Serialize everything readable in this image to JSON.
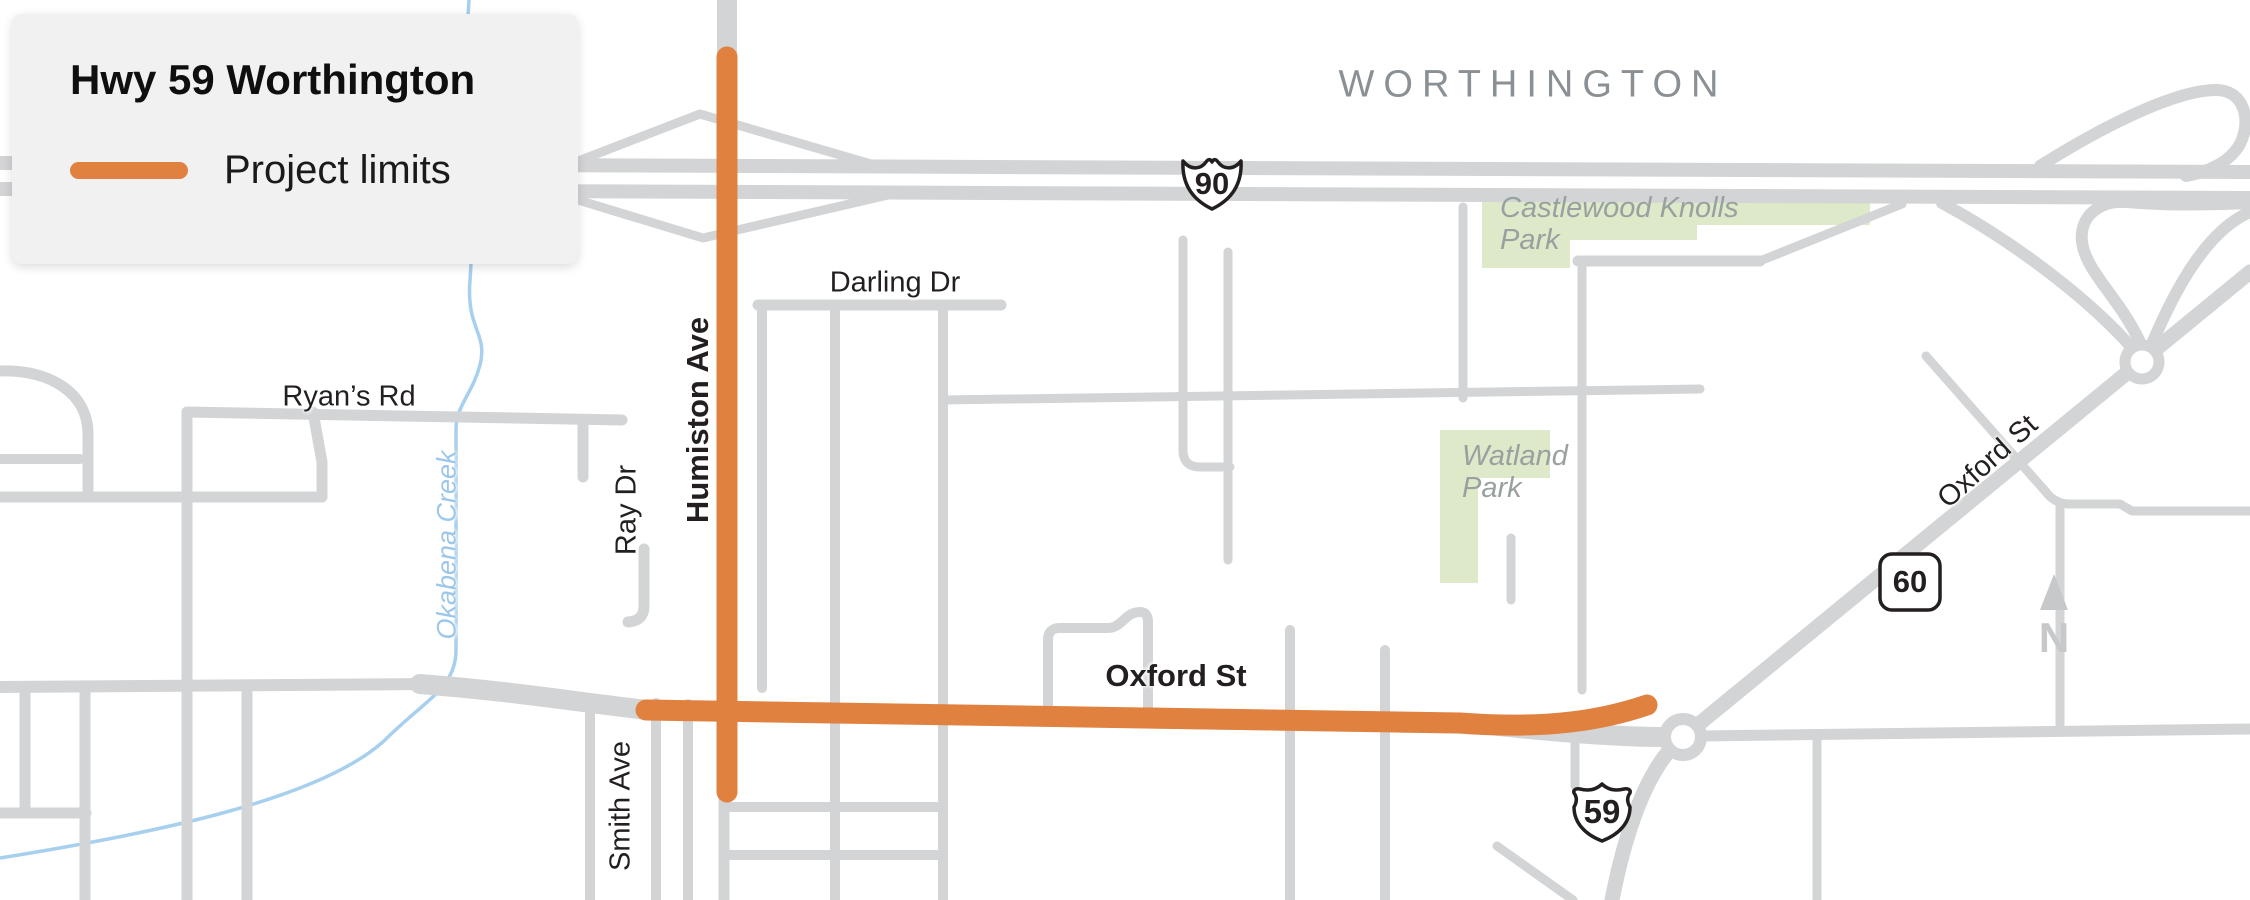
{
  "legend": {
    "title": "Hwy 59 Worthington",
    "items": [
      {
        "label": "Project limits",
        "swatch_color": "#E0813F"
      }
    ]
  },
  "map": {
    "city": "WORTHINGTON",
    "streets": {
      "darling": "Darling Dr",
      "ryans": "Ryan’s Rd",
      "humiston": "Humiston Ave",
      "ray": "Ray Dr",
      "smith": "Smith Ave",
      "oxford": "Oxford St",
      "oxford_ne": "Oxford St"
    },
    "water": {
      "okabena": "Okabena Creek"
    },
    "parks": {
      "castlewood_line1": "Castlewood Knolls",
      "castlewood_line2": "Park",
      "watland_line1": "Watland",
      "watland_line2": "Park"
    },
    "shields": {
      "i90": "90",
      "mn60": "60",
      "us59": "59"
    },
    "north": "N",
    "colors": {
      "project_limits": "#E0813F",
      "road": "#D3D4D6",
      "park_fill": "#DDE9C9",
      "creek": "#A7CFEE",
      "city_text": "#8B9095",
      "park_text": "#99A1A0",
      "north_arrow": "#C6C8CA",
      "legend_background": "#F1F1F2"
    }
  }
}
